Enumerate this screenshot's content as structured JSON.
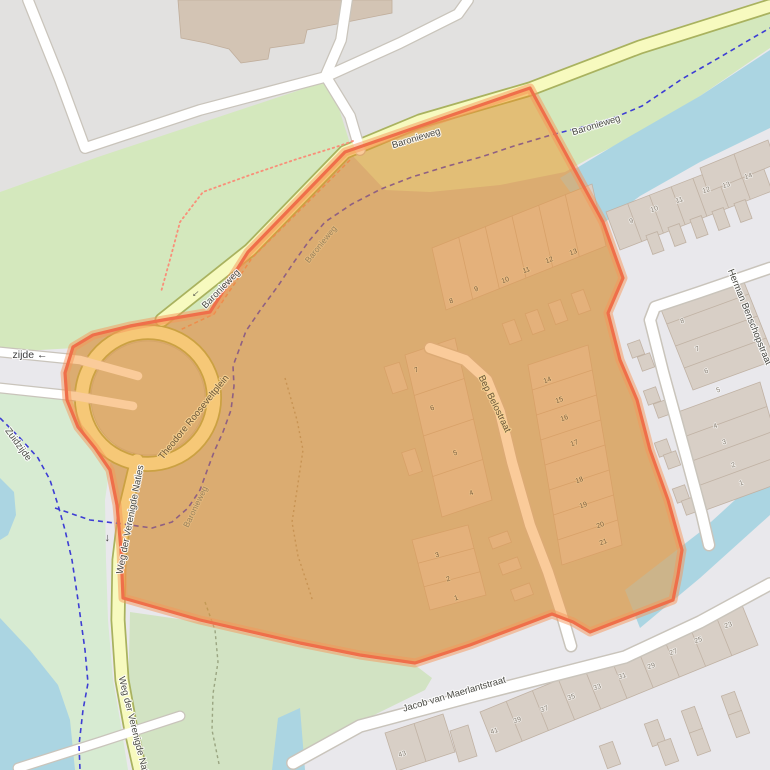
{
  "map": {
    "title": "Map area highlight around Baronieweg / Bep Belostraat",
    "style": "openstreetmap-carto",
    "colors": {
      "background_residential": "#e9e8ec",
      "landuse_gray": "#e2e1e0",
      "construction": "#c7c7b4",
      "grass": "#d4e8bd",
      "grass_pale": "#d7ebd2",
      "water": "#abd5e2",
      "road_yellow": "#f7fabf",
      "road_yellow_casing": "#a9b25f",
      "road_white": "#ffffff",
      "road_white_casing": "#c9c4bb",
      "building": "#d8cfc6",
      "building_outline": "#c0b2a4",
      "building_tan": "#d3c4b4",
      "cycleway_dashed": "#3d3dd4",
      "footpath_dotted": "#f98f79",
      "highlight_fill": "rgba(245,140,30,0.45)",
      "highlight_border": "#ef6f4a"
    },
    "street_labels": [
      {
        "text": "Baronieweg",
        "x": 417,
        "y": 141,
        "rot": -17,
        "cls": "lbl-road"
      },
      {
        "text": "Baronieweg",
        "x": 597,
        "y": 128,
        "rot": -17,
        "cls": "lbl-road"
      },
      {
        "text": "Baronieweg",
        "x": 223,
        "y": 291,
        "rot": -46,
        "cls": "lbl-road"
      },
      {
        "text": "Baronieweg",
        "x": 323,
        "y": 246,
        "rot": -51,
        "cls": "lbl-path-in"
      },
      {
        "text": "Baronieweg",
        "x": 198,
        "y": 508,
        "rot": -64,
        "cls": "lbl-path-in"
      },
      {
        "text": "Theodore Rooseveltplein",
        "x": 196,
        "y": 419,
        "rot": -51,
        "cls": "lbl-road-in"
      },
      {
        "text": "Weg der Verenigde Naties",
        "x": 133,
        "y": 520,
        "rot": -79,
        "cls": "lbl-road"
      },
      {
        "text": "Weg der Verenigde Naties",
        "x": 132,
        "y": 731,
        "rot": 76,
        "cls": "lbl-road"
      },
      {
        "text": "Bep Belostraat",
        "x": 492,
        "y": 405,
        "rot": 64,
        "cls": "lbl-road-in"
      },
      {
        "text": "Herman Benschopstraat",
        "x": 747,
        "y": 318,
        "rot": 68,
        "cls": "lbl-road"
      },
      {
        "text": "Jacob van Maerlantstraat",
        "x": 455,
        "y": 697,
        "rot": -16,
        "cls": "lbl-road"
      },
      {
        "text": "zijde ←",
        "x": 30,
        "y": 358,
        "rot": 0,
        "cls": "lbl-edge"
      },
      {
        "text": "Zuidzijde",
        "x": 16,
        "y": 446,
        "rot": 54,
        "cls": "lbl-road"
      }
    ],
    "oneway_arrows": [
      {
        "glyph": "←",
        "x": 197,
        "y": 295,
        "rot": -42
      },
      {
        "glyph": "←",
        "x": 109,
        "y": 538,
        "rot": -90
      }
    ],
    "house_numbers": {
      "outside": [
        {
          "t": "9",
          "x": 632,
          "y": 223
        },
        {
          "t": "10",
          "x": 655,
          "y": 211
        },
        {
          "t": "11",
          "x": 680,
          "y": 202
        },
        {
          "t": "12",
          "x": 707,
          "y": 192
        },
        {
          "t": "13",
          "x": 727,
          "y": 187
        },
        {
          "t": "14",
          "x": 749,
          "y": 178
        },
        {
          "t": "8",
          "x": 683,
          "y": 323
        },
        {
          "t": "7",
          "x": 698,
          "y": 351
        },
        {
          "t": "6",
          "x": 707,
          "y": 373
        },
        {
          "t": "5",
          "x": 719,
          "y": 392
        },
        {
          "t": "4",
          "x": 716,
          "y": 428
        },
        {
          "t": "3",
          "x": 725,
          "y": 444
        },
        {
          "t": "2",
          "x": 734,
          "y": 467
        },
        {
          "t": "1",
          "x": 742,
          "y": 485
        },
        {
          "t": "43",
          "x": 403,
          "y": 756
        },
        {
          "t": "41",
          "x": 495,
          "y": 733
        },
        {
          "t": "39",
          "x": 518,
          "y": 722
        },
        {
          "t": "37",
          "x": 545,
          "y": 711
        },
        {
          "t": "35",
          "x": 572,
          "y": 699
        },
        {
          "t": "33",
          "x": 598,
          "y": 689
        },
        {
          "t": "31",
          "x": 623,
          "y": 678
        },
        {
          "t": "29",
          "x": 652,
          "y": 668
        },
        {
          "t": "27",
          "x": 674,
          "y": 654
        },
        {
          "t": "25",
          "x": 699,
          "y": 642
        },
        {
          "t": "23",
          "x": 729,
          "y": 627
        }
      ],
      "inside": [
        {
          "t": "8",
          "x": 452,
          "y": 303
        },
        {
          "t": "9",
          "x": 477,
          "y": 291
        },
        {
          "t": "10",
          "x": 506,
          "y": 282
        },
        {
          "t": "11",
          "x": 527,
          "y": 272
        },
        {
          "t": "12",
          "x": 550,
          "y": 262
        },
        {
          "t": "13",
          "x": 574,
          "y": 254
        },
        {
          "t": "7",
          "x": 417,
          "y": 372
        },
        {
          "t": "6",
          "x": 433,
          "y": 410
        },
        {
          "t": "5",
          "x": 456,
          "y": 455
        },
        {
          "t": "4",
          "x": 472,
          "y": 495
        },
        {
          "t": "3",
          "x": 438,
          "y": 557
        },
        {
          "t": "2",
          "x": 449,
          "y": 581
        },
        {
          "t": "1",
          "x": 457,
          "y": 600
        },
        {
          "t": "14",
          "x": 548,
          "y": 382
        },
        {
          "t": "15",
          "x": 560,
          "y": 402
        },
        {
          "t": "16",
          "x": 565,
          "y": 420
        },
        {
          "t": "17",
          "x": 575,
          "y": 445
        },
        {
          "t": "18",
          "x": 580,
          "y": 482
        },
        {
          "t": "19",
          "x": 584,
          "y": 507
        },
        {
          "t": "20",
          "x": 601,
          "y": 527
        },
        {
          "t": "21",
          "x": 604,
          "y": 544
        }
      ]
    }
  }
}
